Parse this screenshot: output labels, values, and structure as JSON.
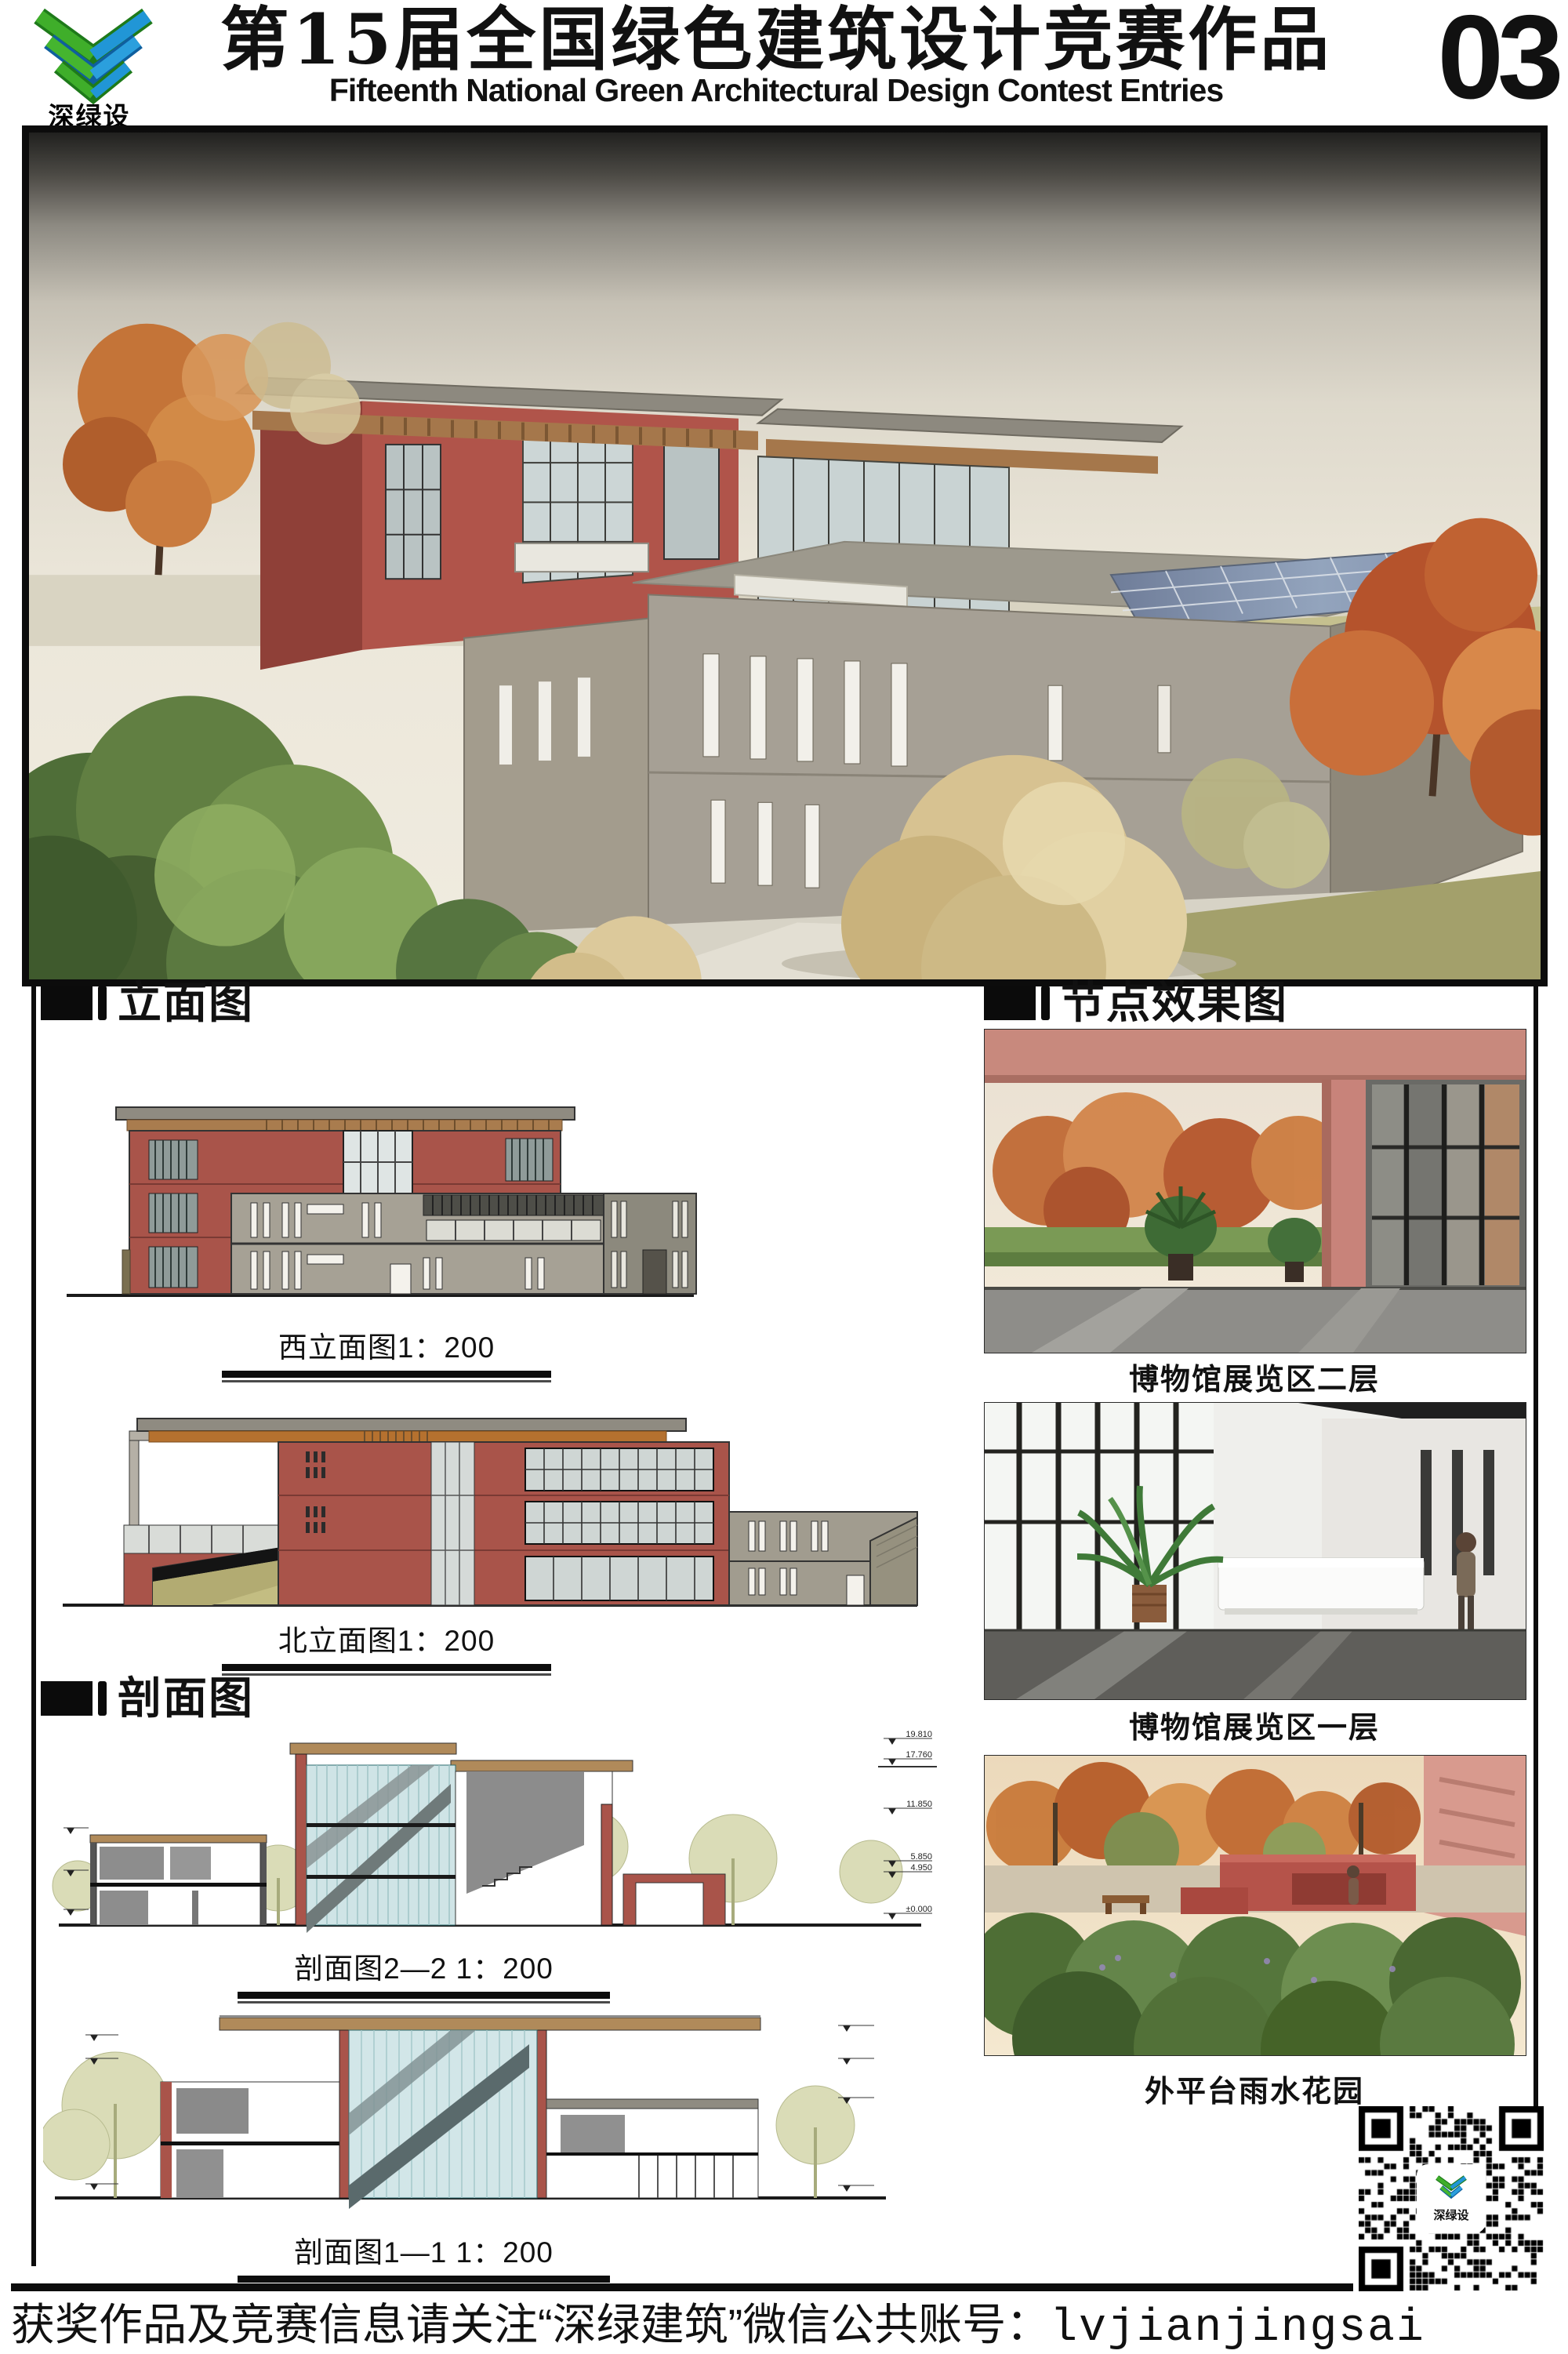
{
  "header": {
    "logo_text": "深绿设",
    "title_cn": "第15届全国绿色建筑设计竞赛作品",
    "title_en": "Fifteenth National Green Architectural Design Contest Entries",
    "page_number": "03"
  },
  "left": {
    "elevation_heading": "立面图",
    "section_heading": "剖面图",
    "elevations": [
      {
        "caption": "西立面图1：200"
      },
      {
        "caption": "北立面图1：200"
      }
    ],
    "sections": [
      {
        "caption": "剖面图2—2  1：200"
      },
      {
        "caption": "剖面图1—1  1：200"
      }
    ]
  },
  "right": {
    "heading": "节点效果图",
    "renders": [
      {
        "caption": "博物馆展览区二层"
      },
      {
        "caption": "博物馆展览区一层"
      },
      {
        "caption": "外平台雨水花园"
      }
    ]
  },
  "levels": {
    "values": [
      "19.810",
      "17.760",
      "11.850",
      "5.850",
      "4.950",
      "±0.000"
    ]
  },
  "qr": {
    "logo_text": "深绿设"
  },
  "footer": {
    "text_cn": "获奖作品及竞赛信息请关注“深绿建筑”微信公共账号：",
    "account": "lvjianjingsai"
  },
  "colors": {
    "brand_green": "#3fae2a",
    "brand_dark_green": "#1e7a1a",
    "brand_blue": "#2196d6",
    "brand_dark_blue": "#0f5f9e",
    "accent_red": "#a9544a",
    "wood": "#a5774b",
    "stone": "#a6a095"
  }
}
